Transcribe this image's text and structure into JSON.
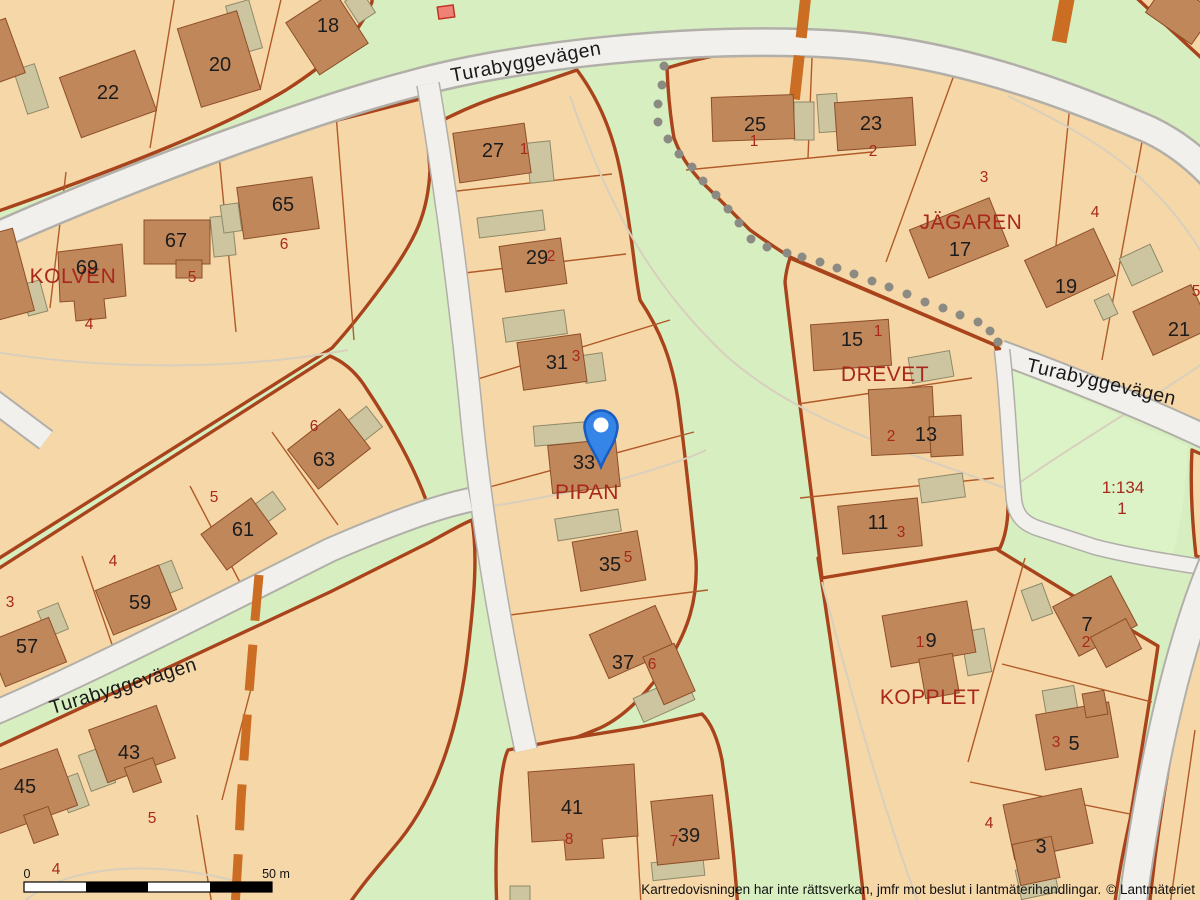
{
  "map": {
    "streets": {
      "turabyggevagen": "Turabyggevägen"
    },
    "blocks": {
      "kolven": "KOLVEN",
      "pipan": "PIPAN",
      "drevet": "DREVET",
      "jagaren": "JÄGAREN",
      "kopplet": "KOPPLET"
    },
    "parcel_1134": {
      "designation": "1:134",
      "lot": "1"
    },
    "house_numbers": {
      "h18": "18",
      "h20": "20",
      "h22": "22",
      "h65": "65",
      "h67": "67",
      "h69": "69",
      "h27": "27",
      "h29": "29",
      "h31": "31",
      "h33": "33",
      "h35": "35",
      "h37": "37",
      "h25": "25",
      "h23": "23",
      "h17": "17",
      "h19": "19",
      "h21": "21",
      "h15": "15",
      "h13": "13",
      "h11": "11",
      "h63": "63",
      "h61": "61",
      "h59": "59",
      "h57": "57",
      "h45": "45",
      "h43": "43",
      "h41": "41",
      "h39": "39",
      "kopplet_h9": "9",
      "kopplet_h7": "7",
      "kopplet_h5": "5",
      "kopplet_h3": "3"
    },
    "lot_numbers": {
      "kolven_4": "4",
      "kolven_5": "5",
      "kolven_6": "6",
      "b11_1": "1",
      "b11_2": "2",
      "b11_3": "3",
      "b11_4": "4",
      "b11_5": "5",
      "pipan_1": "1",
      "pipan_2": "2",
      "pipan_3": "3",
      "pipan_5": "5",
      "pipan_6": "6",
      "drevet_1": "1",
      "drevet_2": "2",
      "drevet_3": "3",
      "s63_6": "6",
      "s61_5": "5",
      "s59_4": "4",
      "s57_3": "3",
      "sw_5": "5",
      "sw_4": "4",
      "mid_8": "8",
      "mid_7": "7",
      "kop_1": "1",
      "kop_2": "2",
      "kop_3": "3",
      "kop_4": "4"
    },
    "icons": {
      "marker": "location-pin"
    }
  },
  "scalebar": {
    "start": "0",
    "end": "50 m"
  },
  "footer": {
    "disclaimer": "Kartredovisningen har inte rättsverkan, jmfr mot beslut i lantmäterihandlingar.",
    "copyright": "© Lantmäteriet"
  },
  "colors": {
    "parcel": "#f6d7a8",
    "greenspace": "#d7efc0",
    "green_lot": "#dcf2c7",
    "building": "#c0875a",
    "outbuilding": "#cdc5a0",
    "road": "#f2f0ed",
    "road_casing": "#b2afa9",
    "boundary": "#a8431c",
    "lot_line": "#b05a28",
    "label_red": "#a8281c",
    "label_black": "#1c1c1c",
    "trail_dot": "#8b8b83",
    "dirt_path": "#cb6d22",
    "pin_blue": "#3585e8",
    "highlight_building": "#ef8276"
  }
}
